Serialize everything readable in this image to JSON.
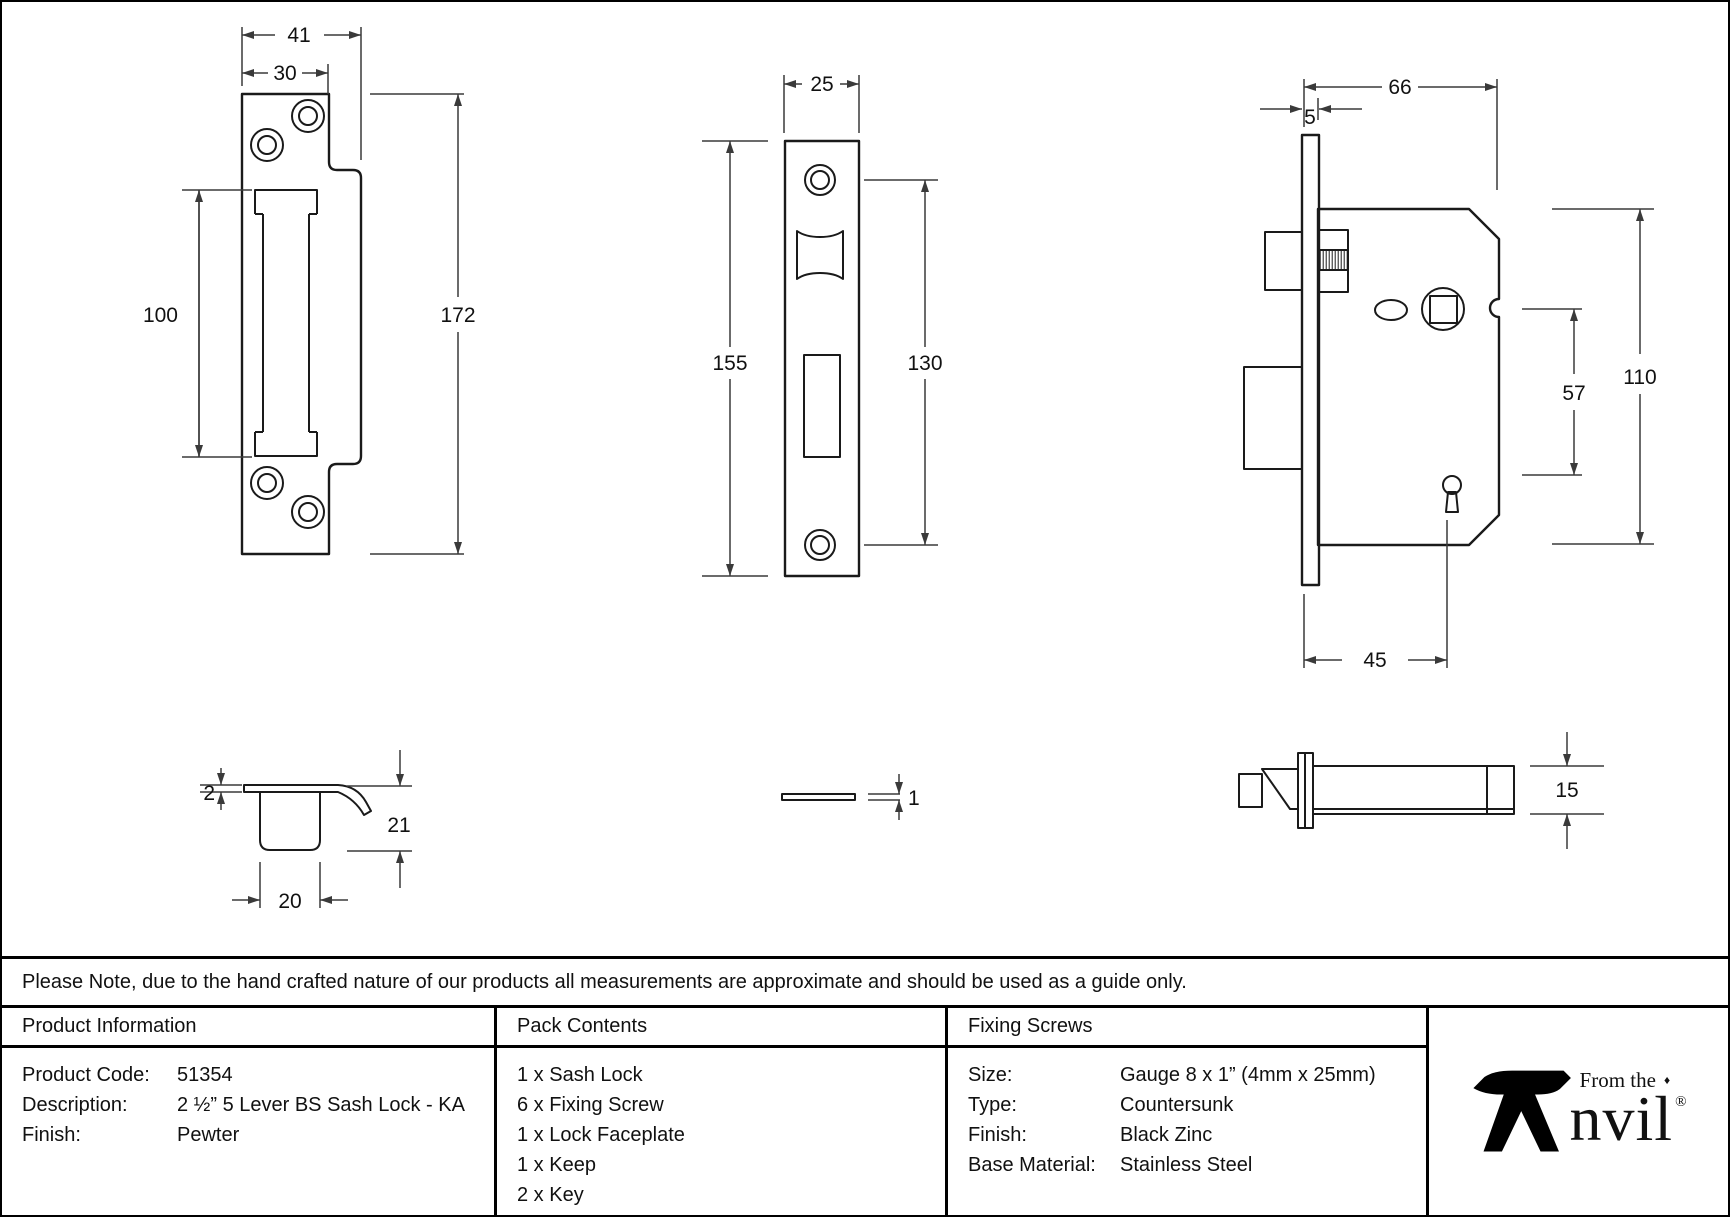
{
  "drawings": {
    "keep_front": {
      "width_outer": "41",
      "width_inner": "30",
      "slot_height": "100",
      "height": "172"
    },
    "faceplate_front": {
      "width": "25",
      "height": "155",
      "screw_spacing": "130"
    },
    "lock_body": {
      "depth": "66",
      "faceplate_offset": "5",
      "height": "110",
      "spindle_to_keyhole": "57",
      "backset": "45"
    },
    "keep_profile": {
      "plate_thickness": "2",
      "depth": "21",
      "box_width": "20"
    },
    "faceplate_edge": {
      "thickness": "1"
    },
    "lock_edge": {
      "thickness": "15"
    }
  },
  "note": "Please Note, due to the hand crafted nature of our products all measurements are approximate and should be used as a guide only.",
  "product_information": {
    "title": "Product Information",
    "rows": [
      {
        "label": "Product Code:",
        "value": "51354"
      },
      {
        "label": "Description:",
        "value": "2 ½” 5 Lever BS Sash Lock - KA"
      },
      {
        "label": "Finish:",
        "value": "Pewter"
      }
    ]
  },
  "pack_contents": {
    "title": "Pack Contents",
    "items": [
      "1 x Sash Lock",
      "6 x Fixing Screw",
      "1 x Lock Faceplate",
      "1 x Keep",
      "2 x Key"
    ]
  },
  "fixing_screws": {
    "title": "Fixing Screws",
    "rows": [
      {
        "label": "Size:",
        "value": "Gauge 8 x 1” (4mm x 25mm)"
      },
      {
        "label": "Type:",
        "value": "Countersunk"
      },
      {
        "label": "Finish:",
        "value": "Black Zinc"
      },
      {
        "label": "Base Material:",
        "value": "Stainless Steel"
      }
    ]
  },
  "logo": {
    "small_text": "From the",
    "diamond": "♦",
    "main_text": "nvil",
    "full_name": "Anvil",
    "registered": "®"
  },
  "colors": {
    "line": "#1a1a1a",
    "text": "#111111",
    "background": "#ffffff",
    "border": "#000000"
  }
}
